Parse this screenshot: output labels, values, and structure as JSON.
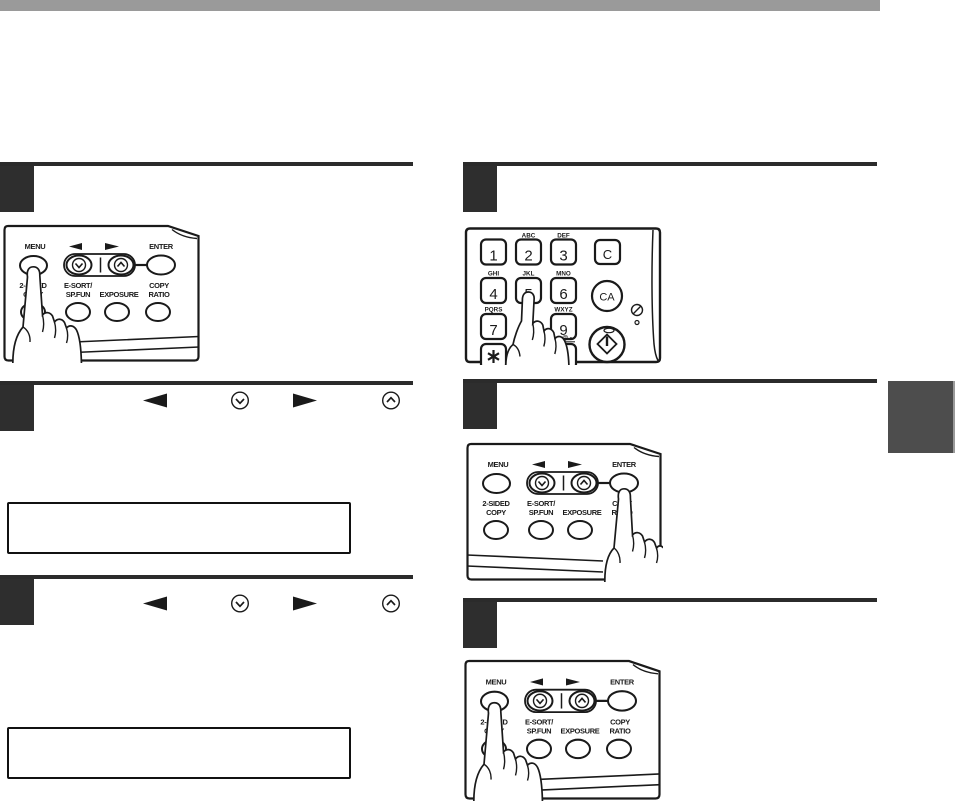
{
  "colors": {
    "header_bar": "#9a9a9a",
    "step_number_box": "#2e2e2e",
    "step_rule": "#2b2b2b",
    "side_tab": "#4d4d4d",
    "line_art": "#1a1a1a"
  },
  "control_panel": {
    "menu_label": "MENU",
    "enter_label": "ENTER",
    "two_sided_line1": "2-SIDED",
    "two_sided_line2": "COPY",
    "esort_line1": "E-SORT/",
    "esort_line2": "SP.FUN",
    "exposure_label": "EXPOSURE",
    "copy_ratio_line1": "COPY",
    "copy_ratio_line2": "RATIO"
  },
  "keypad": {
    "digit_1": "1",
    "digit_2": "2",
    "digit_3": "3",
    "digit_4": "4",
    "digit_5": "5",
    "digit_6": "6",
    "digit_7": "7",
    "digit_9": "9",
    "letters_abc": "ABC",
    "letters_def": "DEF",
    "letters_ghi": "GHI",
    "letters_jkl": "JKL",
    "letters_mno": "MNO",
    "letters_pqrs": "PQRS",
    "letters_wxyz": "WXYZ",
    "symbols_label": "@.-",
    "clear_label": "C",
    "clear_all_label": "CA"
  },
  "icons": {
    "left_arrow_key": "◄",
    "right_arrow_key": "►",
    "scroll_down_key": "circled chevron-down",
    "scroll_up_key": "circled chevron-up",
    "star_key": "✱",
    "start_key": "circled diamond start symbol",
    "energy_icon": "circled slash",
    "indicator_dot": "small circle"
  }
}
